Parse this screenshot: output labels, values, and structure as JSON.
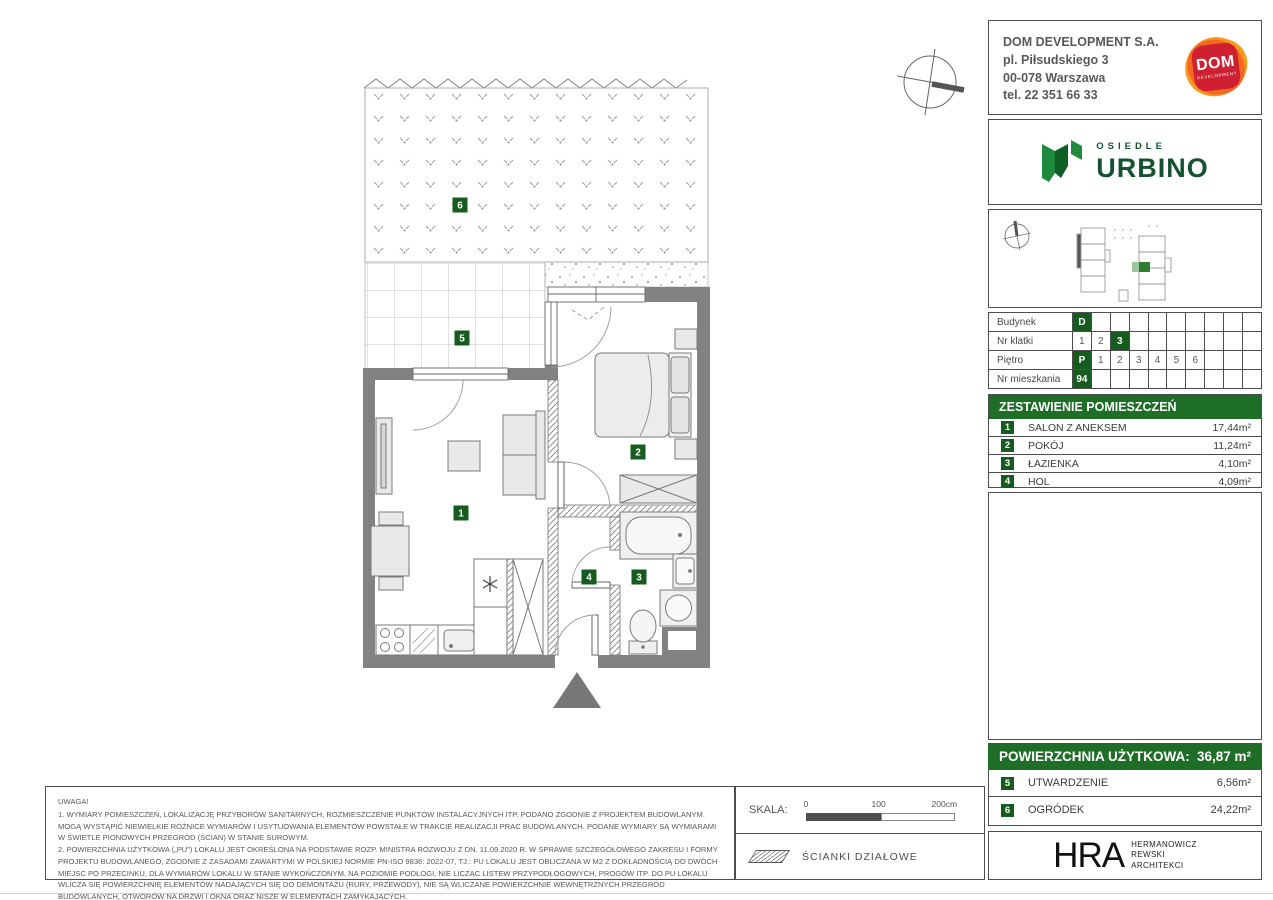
{
  "company": {
    "name": "DOM DEVELOPMENT S.A.",
    "address_line1": "pl. Piłsudskiego 3",
    "address_line2": "00-078 Warszawa",
    "phone": "tel. 22 351 66 33",
    "logo_primary": "DOM",
    "logo_secondary": "DEVELOPMENT"
  },
  "estate": {
    "prefix": "OSIEDLE",
    "name": "URBINO"
  },
  "unit_info": {
    "rows": [
      {
        "label": "Budynek",
        "cells": [
          "D",
          "",
          "",
          "",
          "",
          "",
          "",
          "",
          "",
          ""
        ]
      },
      {
        "label": "Nr klatki",
        "cells": [
          "1",
          "2",
          "3",
          "",
          "",
          "",
          "",
          "",
          "",
          ""
        ]
      },
      {
        "label": "Piętro",
        "cells": [
          "P",
          "1",
          "2",
          "3",
          "4",
          "5",
          "6",
          "",
          "",
          ""
        ]
      },
      {
        "label": "Nr mieszkania",
        "cells": [
          "94",
          "",
          "",
          "",
          "",
          "",
          "",
          "",
          "",
          ""
        ]
      }
    ]
  },
  "rooms": {
    "header": "ZESTAWIENIE POMIESZCZEŃ",
    "unit": "m²",
    "items": [
      {
        "num": "1",
        "name": "SALON Z ANEKSEM",
        "area": "17,44"
      },
      {
        "num": "2",
        "name": "POKÓJ",
        "area": "11,24"
      },
      {
        "num": "3",
        "name": "ŁAZIENKA",
        "area": "4,10"
      },
      {
        "num": "4",
        "name": "HOL",
        "area": "4,09"
      }
    ]
  },
  "summary": {
    "label": "POWIERZCHNIA UŻYTKOWA:",
    "value": "36,87",
    "unit": "m²"
  },
  "outdoor": {
    "unit": "m²",
    "items": [
      {
        "num": "5",
        "name": "UTWARDZENIE",
        "area": "6,56"
      },
      {
        "num": "6",
        "name": "OGRÓDEK",
        "area": "24,22"
      }
    ]
  },
  "plan": {
    "badges": [
      "1",
      "2",
      "3",
      "4",
      "5",
      "6"
    ]
  },
  "scale": {
    "label": "SKALA:",
    "tick0": "0",
    "tick1": "100",
    "tick2": "200cm"
  },
  "legend": {
    "partition_walls": "ŚCIANKI DZIAŁOWE"
  },
  "architect": {
    "abbr": "HRA",
    "line1": "HERMANOWICZ",
    "line2": "REWSKI",
    "line3": "ARCHITEKCI"
  },
  "notes": {
    "title": "UWAGA!",
    "item1": "1. WYMIARY POMIESZCZEŃ, LOKALIZACJĘ PRZYBORÓW SANITARNYCH, ROZMIESZCZENIE PUNKTÓW INSTALACYJNYCH ITP. PODANO ZGODNIE Z PROJEKTEM BUDOWLANYM. MOGĄ WYSTĄPIĆ NIEWIELKIE RÓŻNICE WYMIARÓW I USYTUOWANIA ELEMENTÓW POWSTAŁE W TRAKCIE REALIZACJI PRAC BUDOWLANYCH. PODANE WYMIARY SĄ WYMIARAMI W ŚWIETLE PIONOWYCH PRZEGRÓD (ŚCIAN) W STANIE SUROWYM.",
    "item2": "2. POWIERZCHNIA UŻYTKOWA („PU”) LOKALU JEST OKREŚLONA NA PODSTAWIE ROZP. MINISTRA ROZWOJU Z DN. 11.09.2020 R. W SPRAWIE SZCZEGÓŁOWEGO ZAKRESU I FORMY PROJEKTU BUDOWLANEGO, ZGODNIE Z ZASADAMI ZAWARTYMI W POLSKIEJ NORMIE PN-ISO 9836: 2022-07, TJ.: PU LOKALU JEST OBLICZANA W M2 Z DOKŁADNOŚCIĄ DO DWÓCH MIEJSC PO PRZECINKU, DLA WYMIARÓW LOKALU W STANIE WYKOŃCZONYM, NA POZIOMIE PODŁOGI, NIE LICZĄC LISTEW PRZYPODŁOGOWYCH, PROGÓW ITP. DO PU LOKALU WLICZA SIĘ POWIERZCHNIĘ ELEMENTÓW NADAJĄCYCH SIĘ DO DEMONTAŻU (RURY, PRZEWODY), NIE SĄ WLICZANE POWIERZCHNIE WEWNĘTRZNYCH PRZEGRÓD BUDOWLANYCH, OTWORÓW NA DRZWI I OKNA ORAZ NISZE W ELEMENTACH ZAMYKAJĄCYCH.",
    "item3": "3. PRZEDSTAWIONA NA RZUCIE ARANŻACJA MA CHARAKTER PRZYKŁADOWY, UMEBLOWANIE NIE STANOWI WYPOSAŻENIA NABYWANEGO LOKALU."
  },
  "colors": {
    "accent_green": "#1f6e28",
    "badge_green": "#155c1e",
    "wall_gray": "#828282"
  }
}
